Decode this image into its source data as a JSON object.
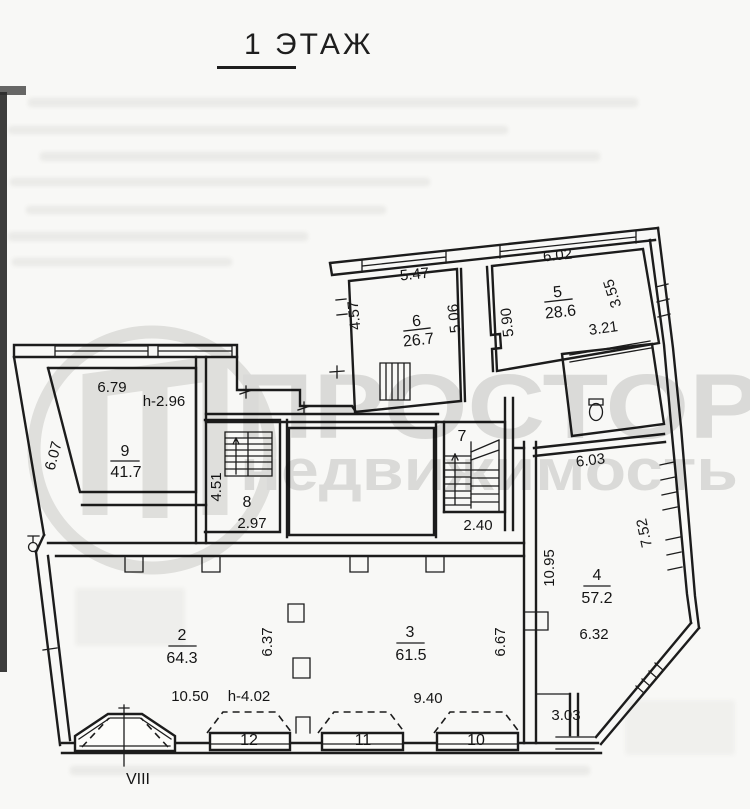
{
  "title": "1 ЭТАЖ",
  "watermark": {
    "brand": "ПРОСТОР",
    "brand_sub": "недвижимость"
  },
  "colors": {
    "ink": "#1c1c1c",
    "paper": "#f8f8f6",
    "watermark_gray": "#cfcfcd"
  },
  "rooms": {
    "r2": {
      "number": "2",
      "area": "64.3"
    },
    "r3": {
      "number": "3",
      "area": "61.5"
    },
    "r4": {
      "number": "4",
      "area": "57.2"
    },
    "r5": {
      "number": "5",
      "area": "28.6"
    },
    "r6": {
      "number": "6",
      "area": "26.7"
    },
    "r7": {
      "number": "7"
    },
    "r8": {
      "number": "8"
    },
    "r9": {
      "number": "9",
      "area": "41.7"
    },
    "p10": {
      "number": "10"
    },
    "p11": {
      "number": "11"
    },
    "p12": {
      "number": "12"
    },
    "bay": {
      "number": "VIII"
    }
  },
  "dimensions": {
    "d547": "5.47",
    "d457": "4.57",
    "d506": "5.06",
    "d602": "6.02",
    "d590": "5.90",
    "d355": "3.55",
    "d321": "3.21",
    "d679": "6.79",
    "h296": "h-2.96",
    "d607": "6.07",
    "d451": "4.51",
    "d297": "2.97",
    "d240": "2.40",
    "d603": "6.03",
    "d1095": "10.95",
    "d752": "7.52",
    "d632": "6.32",
    "d303": "3.03",
    "d1050": "10.50",
    "h402": "h-4.02",
    "d637": "6.37",
    "d940": "9.40",
    "d667": "6.67"
  }
}
